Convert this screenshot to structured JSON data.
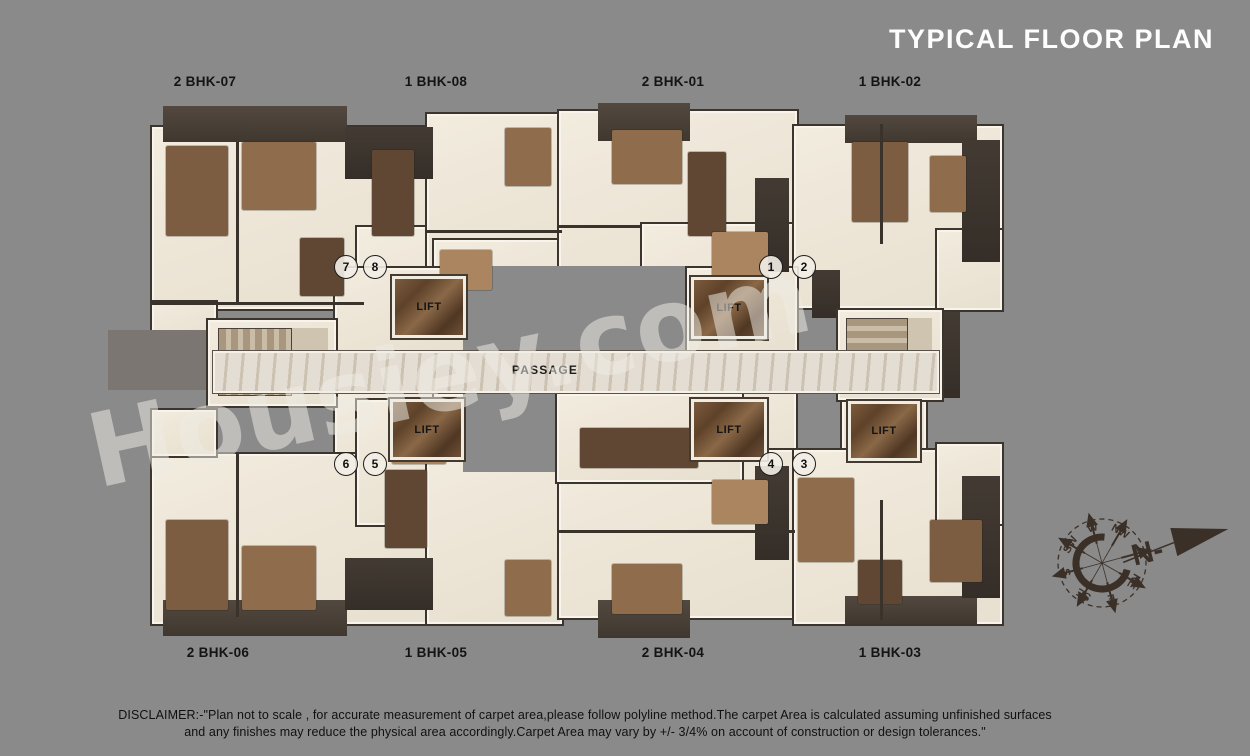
{
  "title": "TYPICAL FLOOR PLAN",
  "watermark": "Housiey.com",
  "units": {
    "top": [
      {
        "label": "2 BHK-07"
      },
      {
        "label": "1 BHK-08"
      },
      {
        "label": "2 BHK-01"
      },
      {
        "label": "1 BHK-02"
      }
    ],
    "bottom": [
      {
        "label": "2 BHK-06"
      },
      {
        "label": "1 BHK-05"
      },
      {
        "label": "2 BHK-04"
      },
      {
        "label": "1 BHK-03"
      }
    ]
  },
  "plan": {
    "passage_label": "PASSAGE",
    "lift_label": "LIFT",
    "unit_numbers": [
      "7",
      "8",
      "1",
      "2",
      "6",
      "5",
      "4",
      "3"
    ]
  },
  "compass": {
    "points": [
      "N",
      "NE",
      "E",
      "SE",
      "S",
      "SW",
      "W",
      "NW"
    ],
    "north_label": "N-"
  },
  "disclaimer": {
    "line1": "DISCLAIMER:-\"Plan not to scale , for accurate measurement of carpet area,please follow polyline method.The carpet Area is calculated assuming unfinished surfaces",
    "line2": "and any finishes may reduce the physical area accordingly.Carpet Area may vary by +/- 3/4% on account of construction or design tolerances.\""
  },
  "colors": {
    "background": "#8a8a8a",
    "title_text": "#ffffff",
    "label_text": "#141414",
    "plan_floor": "#efe8db",
    "roof_dark": "#463d35",
    "lift_marble": "#6f5138",
    "passage_floor": "#d9cfc0",
    "compass_ink": "#3b3028",
    "watermark_text": "rgba(237,235,229,0.52)"
  }
}
